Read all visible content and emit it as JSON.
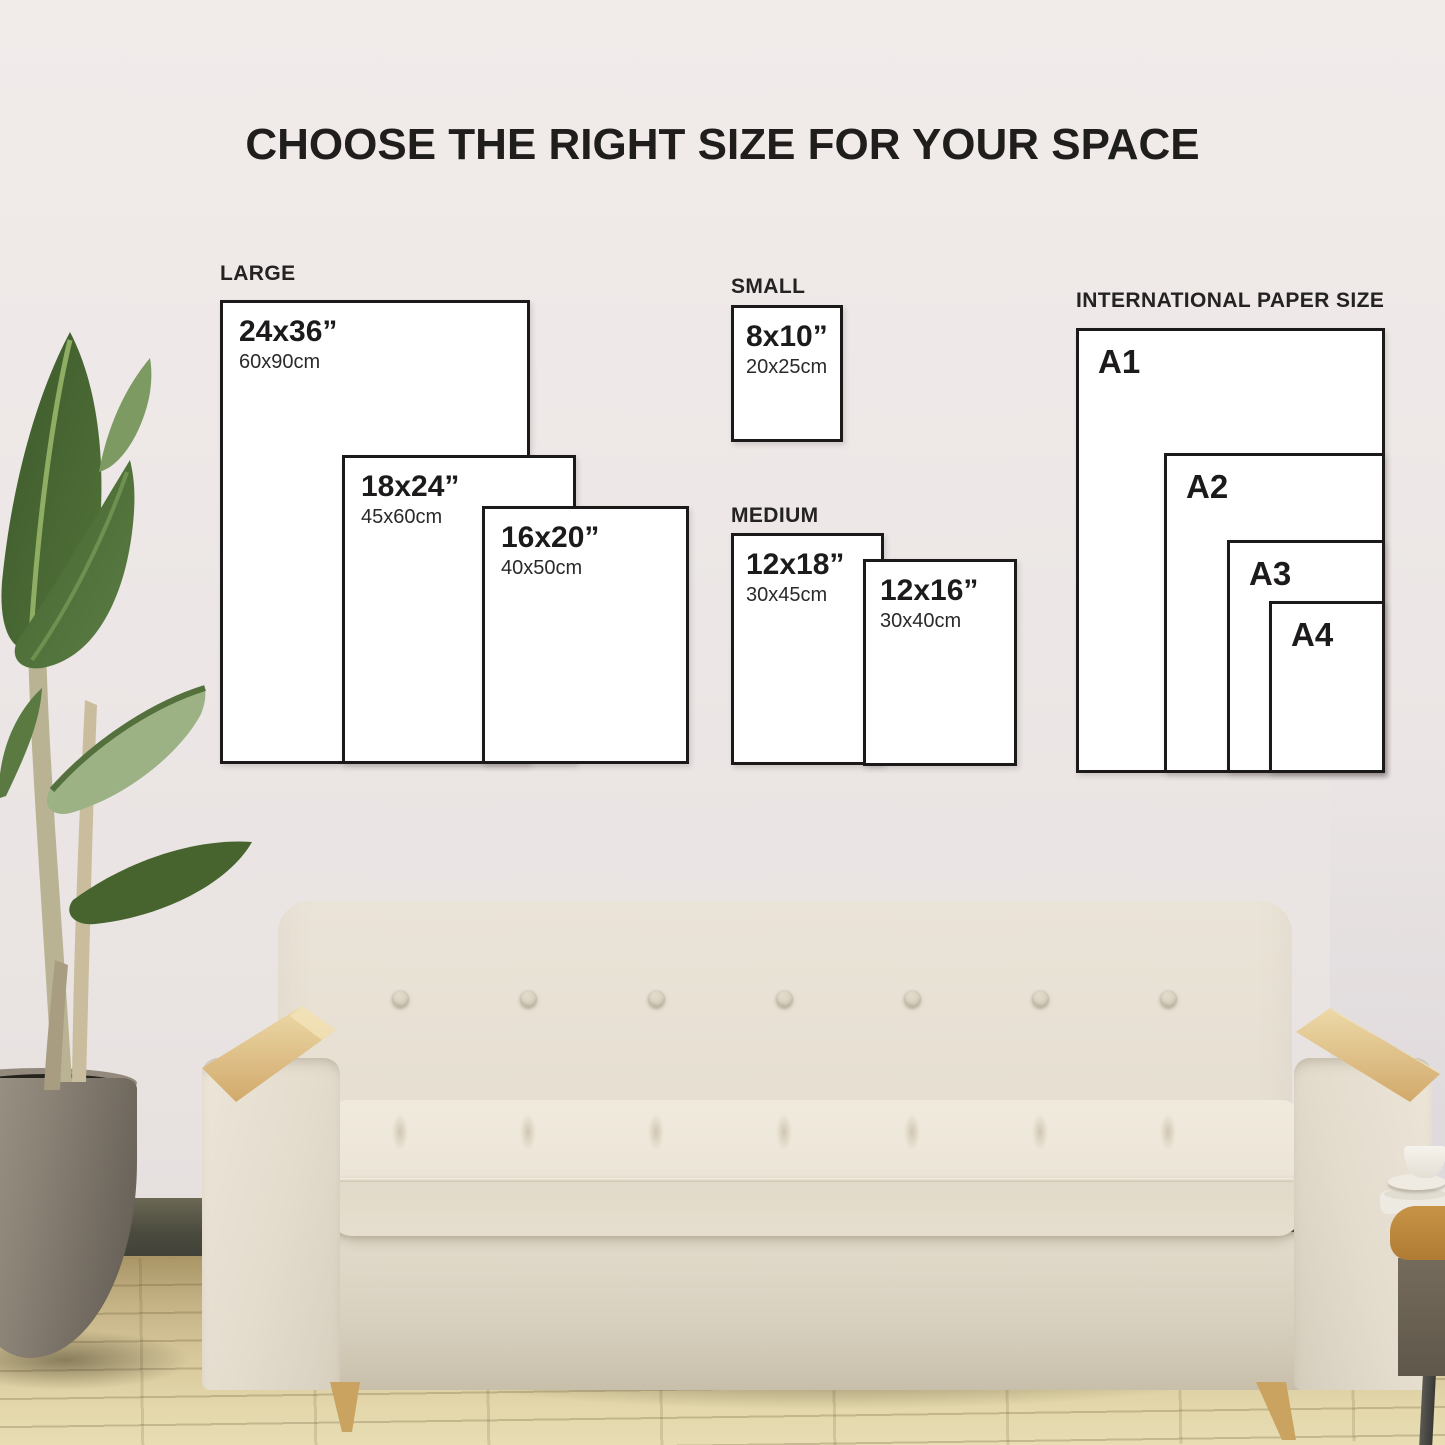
{
  "title": "CHOOSE THE RIGHT SIZE FOR YOUR SPACE",
  "groups": {
    "large": {
      "label": "LARGE",
      "sizes": [
        {
          "inch": "24x36”",
          "cm": "60x90cm"
        },
        {
          "inch": "18x24”",
          "cm": "45x60cm"
        },
        {
          "inch": "16x20”",
          "cm": "40x50cm"
        }
      ]
    },
    "small": {
      "label": "SMALL",
      "sizes": [
        {
          "inch": "8x10”",
          "cm": "20x25cm"
        }
      ]
    },
    "medium": {
      "label": "MEDIUM",
      "sizes": [
        {
          "inch": "12x18”",
          "cm": "30x45cm"
        },
        {
          "inch": "12x16”",
          "cm": "30x40cm"
        }
      ]
    },
    "international": {
      "label": "INTERNATIONAL PAPER SIZE",
      "sizes": [
        {
          "name": "A1"
        },
        {
          "name": "A2"
        },
        {
          "name": "A3"
        },
        {
          "name": "A4"
        }
      ]
    }
  },
  "palette": {
    "box_border": "#1b1919",
    "box_fill": "#ffffff",
    "title_text": "#201d1d",
    "wall": "#ece7e6",
    "baseboard": "#4a4a3e",
    "floor_light": "#e3d7ab",
    "floor_dark": "#a99566",
    "sofa_fabric": "#e6dfd2",
    "sofa_cushion": "#ece5d7",
    "arm_wood": "#ddbd85",
    "leg_wood": "#c9a35f",
    "leaf_dark": "#3f5c2e",
    "leaf_pale": "#9cb284",
    "pot": "#8b8276",
    "table_wood": "#c79345"
  }
}
